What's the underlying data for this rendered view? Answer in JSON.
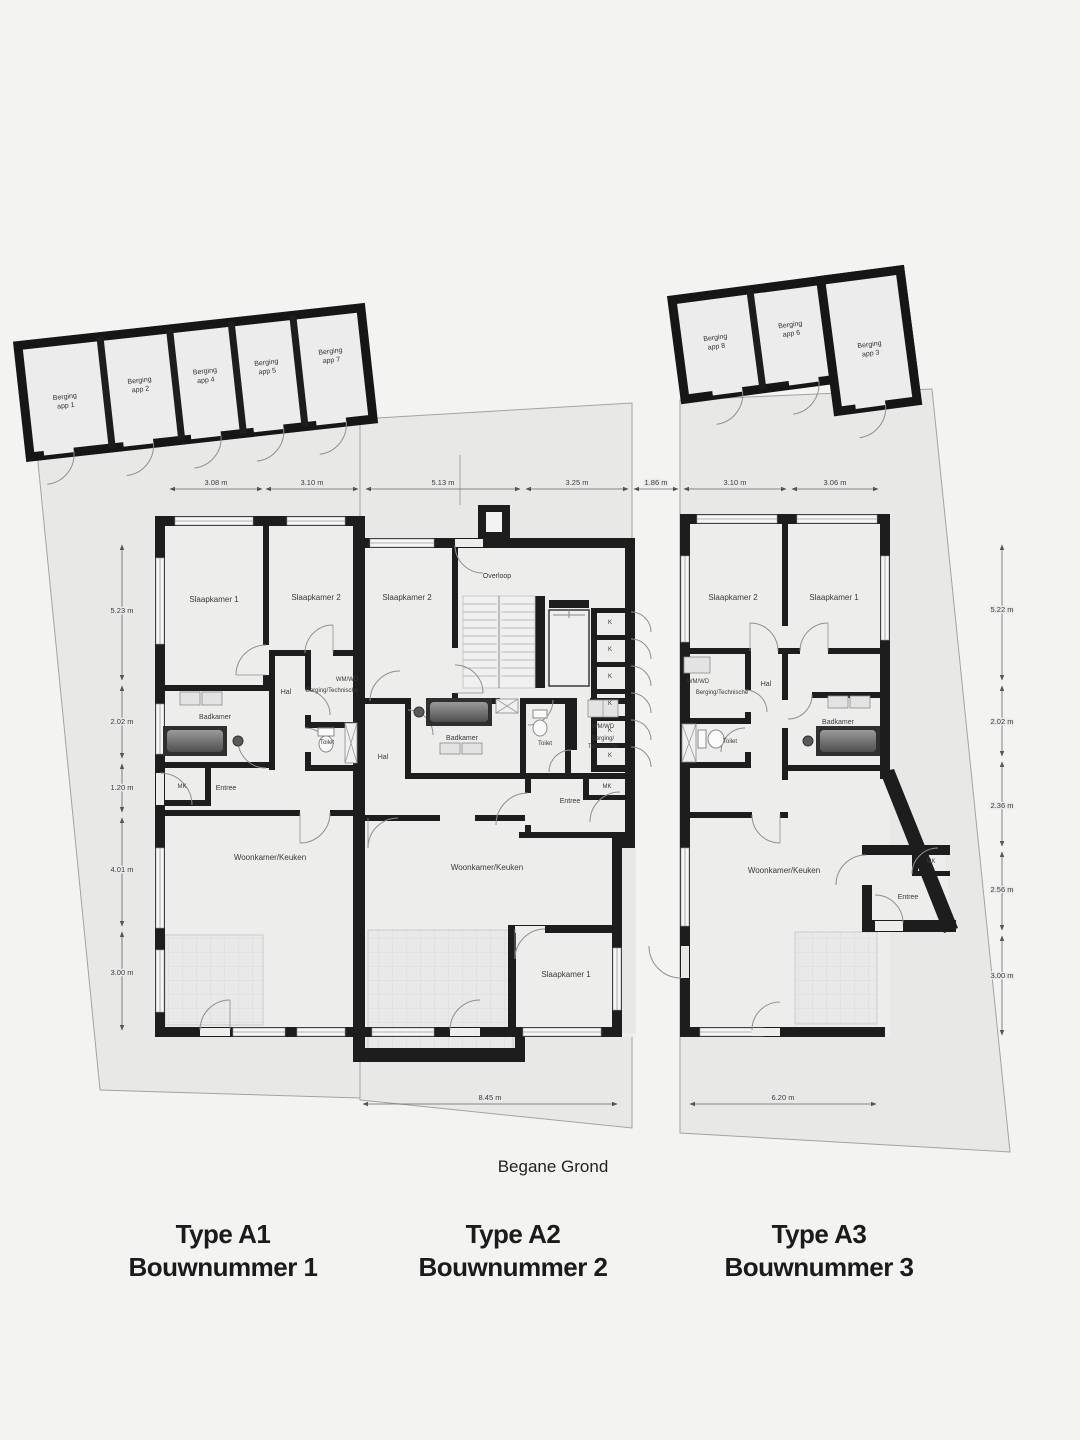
{
  "floor_label": "Begane Grond",
  "captions": [
    {
      "type": "Type A1",
      "bouwnummer": "Bouwnummer 1"
    },
    {
      "type": "Type A2",
      "bouwnummer": "Bouwnummer 2"
    },
    {
      "type": "Type A3",
      "bouwnummer": "Bouwnummer 3"
    }
  ],
  "storage_left": {
    "units": [
      {
        "name": "Berging",
        "app": "app 1"
      },
      {
        "name": "Berging",
        "app": "app 2"
      },
      {
        "name": "Berging",
        "app": "app 4"
      },
      {
        "name": "Berging",
        "app": "app 5"
      },
      {
        "name": "Berging",
        "app": "app 7"
      }
    ]
  },
  "storage_right": {
    "units": [
      {
        "name": "Berging",
        "app": "app 8"
      },
      {
        "name": "Berging",
        "app": "app 6"
      },
      {
        "name": "Berging",
        "app": "app 3"
      }
    ]
  },
  "dimensions": {
    "top": [
      "3.08 m",
      "3.10 m",
      "5.13 m",
      "3.25 m",
      "1.86 m",
      "3.10 m",
      "3.06 m"
    ],
    "left": [
      "5.23 m",
      "2.02 m",
      "1.20 m",
      "4.01 m",
      "3.00 m"
    ],
    "right": [
      "5.22 m",
      "2.02 m",
      "2.36 m",
      "2.56 m",
      "3.00 m"
    ],
    "bottom": [
      "8.45 m",
      "6.20 m"
    ]
  },
  "unit_a1": {
    "slaapkamer1": "Slaapkamer 1",
    "slaapkamer2": "Slaapkamer 2",
    "hal": "Hal",
    "wmwd": "WM/WD",
    "berging_technische": "Berging/Technische",
    "badkamer": "Badkamer",
    "toilet": "Toilet",
    "mk": "MK",
    "entree": "Entree",
    "woonkamer": "Woonkamer/Keuken"
  },
  "unit_a2": {
    "slaapkamer2": "Slaapkamer 2",
    "overloop": "Overloop",
    "hal": "Hal",
    "badkamer": "Badkamer",
    "toilet": "Toilet",
    "wmwd": "WM/WD",
    "berging1": "Berging/",
    "berging2": "Technische",
    "kast": "K",
    "mk": "MK",
    "entree": "Entree",
    "woonkamer": "Woonkamer/Keuken",
    "slaapkamer1": "Slaapkamer 1"
  },
  "unit_a3": {
    "slaapkamer2": "Slaapkamer 2",
    "slaapkamer1": "Slaapkamer 1",
    "wmwd": "WM/WD",
    "berging_technische": "Berging/Technische",
    "hal": "Hal",
    "toilet": "Toilet",
    "badkamer": "Badkamer",
    "mk": "MK",
    "entree": "Entree",
    "woonkamer": "Woonkamer/Keuken"
  }
}
